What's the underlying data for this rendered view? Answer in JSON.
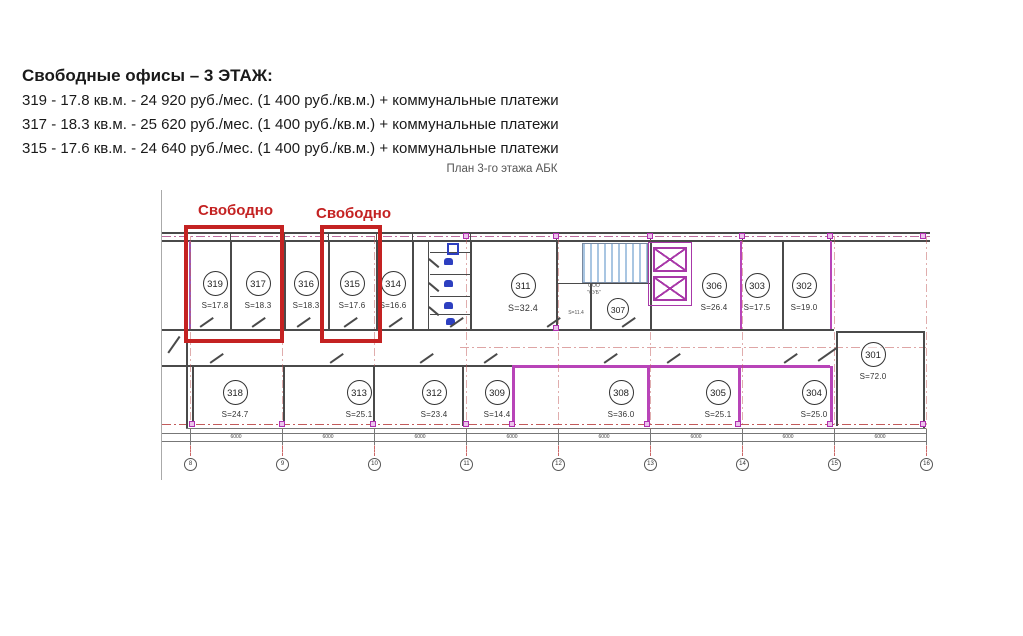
{
  "header": {
    "title": "Свободные офисы – 3 ЭТАЖ:",
    "offers": [
      "319 - 17.8 кв.м. - 24 920 руб./мес. (1 400 руб./кв.м.) + коммунальные платежи",
      "317 - 18.3 кв.м. - 25 620 руб./мес. (1 400 руб./кв.м.) + коммунальные платежи",
      "315 - 17.6 кв.м. - 24 640 руб./мес. (1 400 руб./кв.м.) + коммунальные платежи"
    ]
  },
  "plan": {
    "title": "План 3-го этажа АБК",
    "free_labels": [
      "Свободно",
      "Свободно"
    ],
    "tenant": {
      "line1": "ООО",
      "line2": "\"СУБ\""
    },
    "rooms": [
      {
        "number": "319",
        "area": "S=17.8"
      },
      {
        "number": "317",
        "area": "S=18.3"
      },
      {
        "number": "316",
        "area": "S=18.3"
      },
      {
        "number": "315",
        "area": "S=17.6"
      },
      {
        "number": "314",
        "area": "S=16.6"
      },
      {
        "number": "311",
        "area": "S=32.4"
      },
      {
        "number": "307",
        "area": "S=11.4"
      },
      {
        "number": "306",
        "area": "S=26.4"
      },
      {
        "number": "303",
        "area": "S=17.5"
      },
      {
        "number": "302",
        "area": "S=19.0"
      },
      {
        "number": "318",
        "area": "S=24.7"
      },
      {
        "number": "313",
        "area": "S=25.1"
      },
      {
        "number": "312",
        "area": "S=23.4"
      },
      {
        "number": "309",
        "area": "S=14.4"
      },
      {
        "number": "308",
        "area": "S=36.0"
      },
      {
        "number": "305",
        "area": "S=25.1"
      },
      {
        "number": "304",
        "area": "S=25.0"
      },
      {
        "number": "301",
        "area": "S=72.0"
      }
    ],
    "axes": {
      "labels": [
        "8",
        "9",
        "10",
        "11",
        "12",
        "13",
        "14",
        "15",
        "16"
      ],
      "dims": [
        "6000",
        "6000",
        "6000",
        "6000",
        "6000",
        "6000",
        "6000",
        "6000"
      ]
    },
    "colors": {
      "annotation_red": "#c42222",
      "wall_dark": "#4a4a4a",
      "wall_magenta": "#b844b8",
      "axis_red": "#c25b5b",
      "fixture_blue": "#2d3fc0",
      "stair_blue": "#a9c6e2"
    }
  }
}
